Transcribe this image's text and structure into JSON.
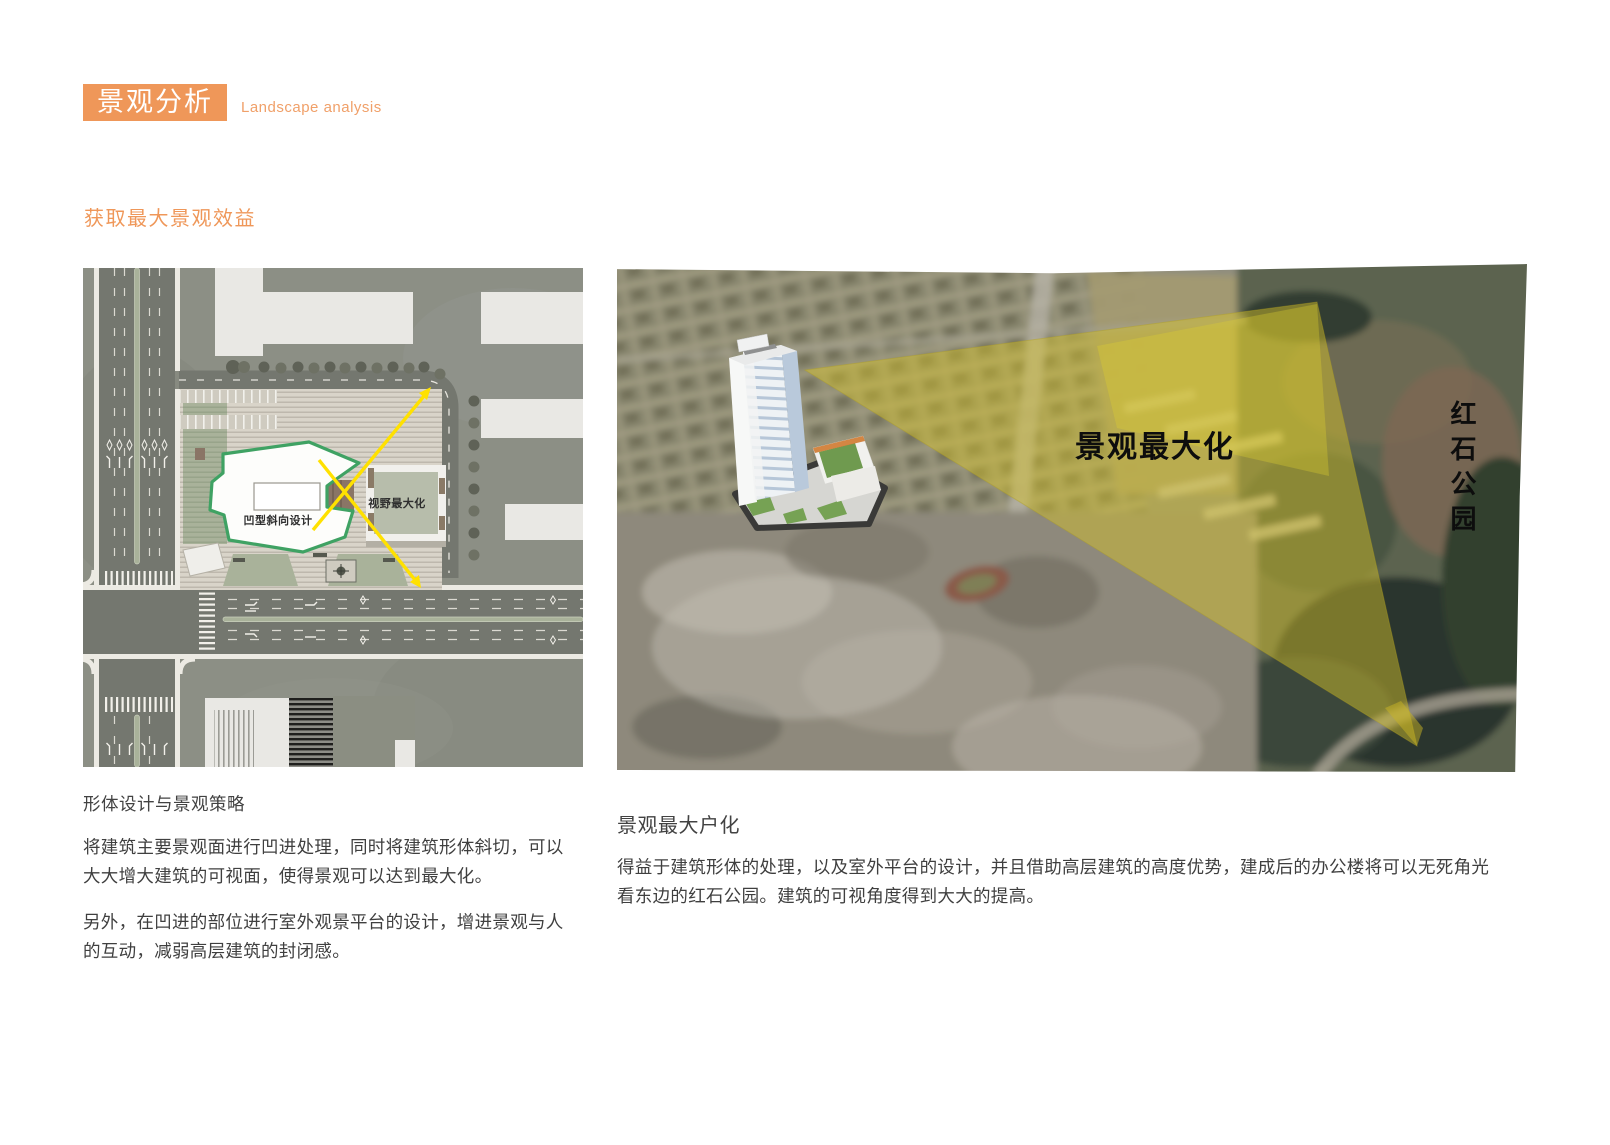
{
  "header": {
    "badge_label": "景观分析",
    "subtitle": "Landscape analysis"
  },
  "section_title": "获取最大景观效益",
  "site_plan": {
    "label_concave_design": "凹型斜向设计",
    "label_view_maximize": "视野最大化"
  },
  "aerial_view": {
    "label_landscape_maximize": "景观最大化",
    "label_park_vertical": "红石公园"
  },
  "left_text": {
    "heading": "形体设计与景观策略",
    "para1": "将建筑主要景观面进行凹进处理，同时将建筑形体斜切，可以大大增大建筑的可视面，使得景观可以达到最大化。",
    "para2": "另外，在凹进的部位进行室外观景平台的设计，增进景观与人的互动，减弱高层建筑的封闭感。"
  },
  "right_text": {
    "heading": "景观最大户化",
    "para1": "得益于建筑形体的处理，以及室外平台的设计，并且借助高层建筑的高度优势，建成后的办公楼将可以无死角光看东边的红石公园。建筑的可视角度得到大大的提高。"
  },
  "colors": {
    "accent_orange": "#ef9759",
    "footprint_green": "#3fa263",
    "arrow_yellow": "#ffe100",
    "view_cone_yellow": "#d2c23e",
    "plan_background": "#8c8f85",
    "label_text_dark": "#0d0d0d"
  }
}
